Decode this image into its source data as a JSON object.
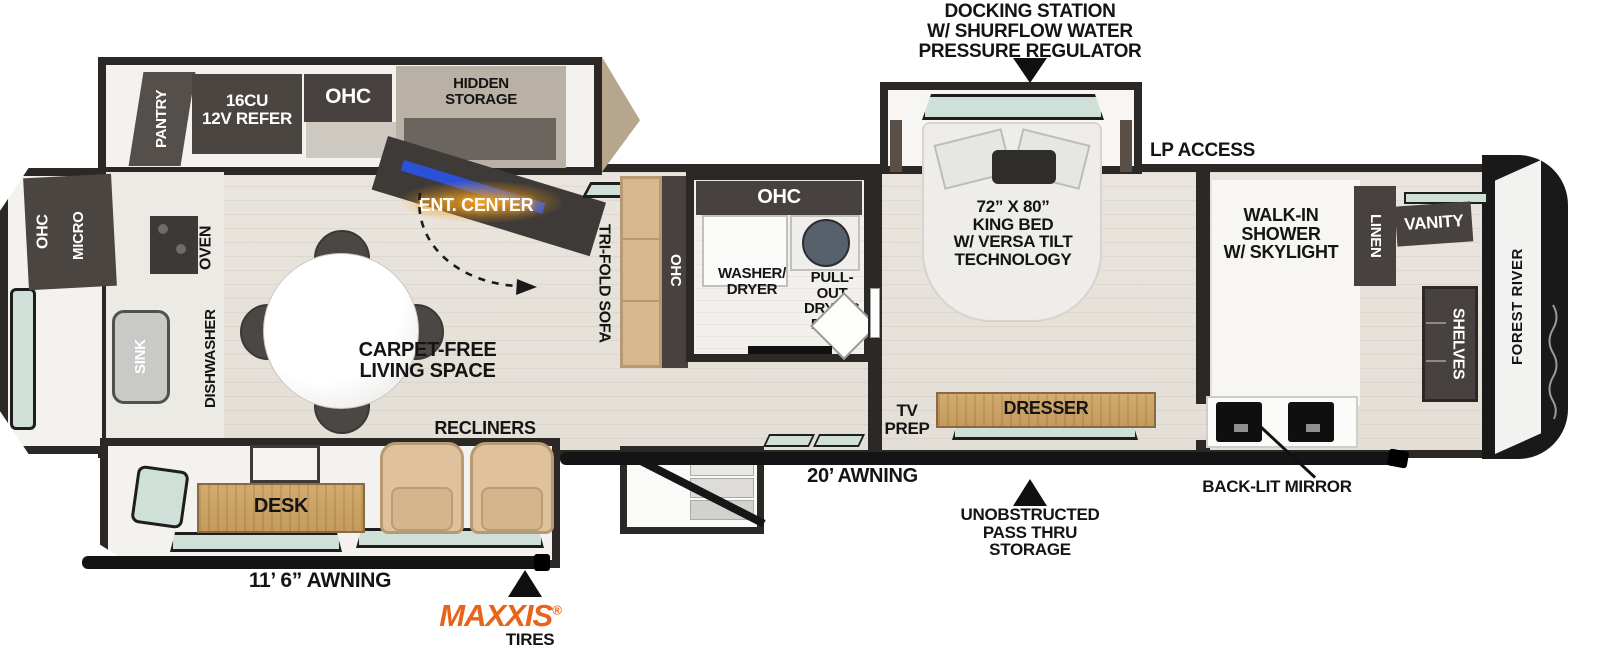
{
  "callouts": {
    "docking_station": "DOCKING STATION\nW/ SHURFLOW WATER\nPRESSURE REGULATOR",
    "lp_access": "LP ACCESS",
    "awning_20": "20’ AWNING",
    "pass_thru_storage": "UNOBSTRUCTED\nPASS THRU\nSTORAGE",
    "backlit_mirror": "BACK-LIT MIRROR",
    "awning_11_6": "11’ 6” AWNING",
    "maxxis": "MAXXIS",
    "maxxis_reg": "®",
    "tires": "TIRES"
  },
  "exterior": {
    "brand": "FOREST RIVER"
  },
  "kitchen": {
    "pantry": "PANTRY",
    "refer": "16CU\n12V REFER",
    "ohc_top": "OHC",
    "hidden_storage": "HIDDEN\nSTORAGE",
    "ohc_left": "OHC",
    "micro": "MICRO",
    "oven": "OVEN",
    "sink": "SINK",
    "dishwasher": "DISHWASHER"
  },
  "living": {
    "ent_center": "ENT. CENTER",
    "tri_fold_sofa": "TRI-FOLD SOFA",
    "sofa_ohc": "OHC",
    "carpet_free": "CARPET-FREE\nLIVING SPACE",
    "recliners": "RECLINERS",
    "desk": "DESK"
  },
  "laundry": {
    "ohc": "OHC",
    "washer_dryer": "WASHER/\nDRYER",
    "drying_rack": "PULL-OUT\nDRYING\nRACK"
  },
  "bedroom": {
    "king_bed": "72” X 80”\nKING BED\nW/ VERSA TILT\nTECHNOLOGY",
    "tv_prep": "TV\nPREP",
    "dresser": "DRESSER"
  },
  "bathroom": {
    "walk_in_shower": "WALK-IN\nSHOWER\nW/ SKYLIGHT",
    "linen": "LINEN",
    "vanity": "VANITY",
    "shelves": "SHELVES"
  },
  "colors": {
    "wall": "#2b2825",
    "cabinet": "#474240",
    "window": "#cfe0d8",
    "maxxis_orange": "#e8641b",
    "glow_orange": "#f7a21e"
  }
}
